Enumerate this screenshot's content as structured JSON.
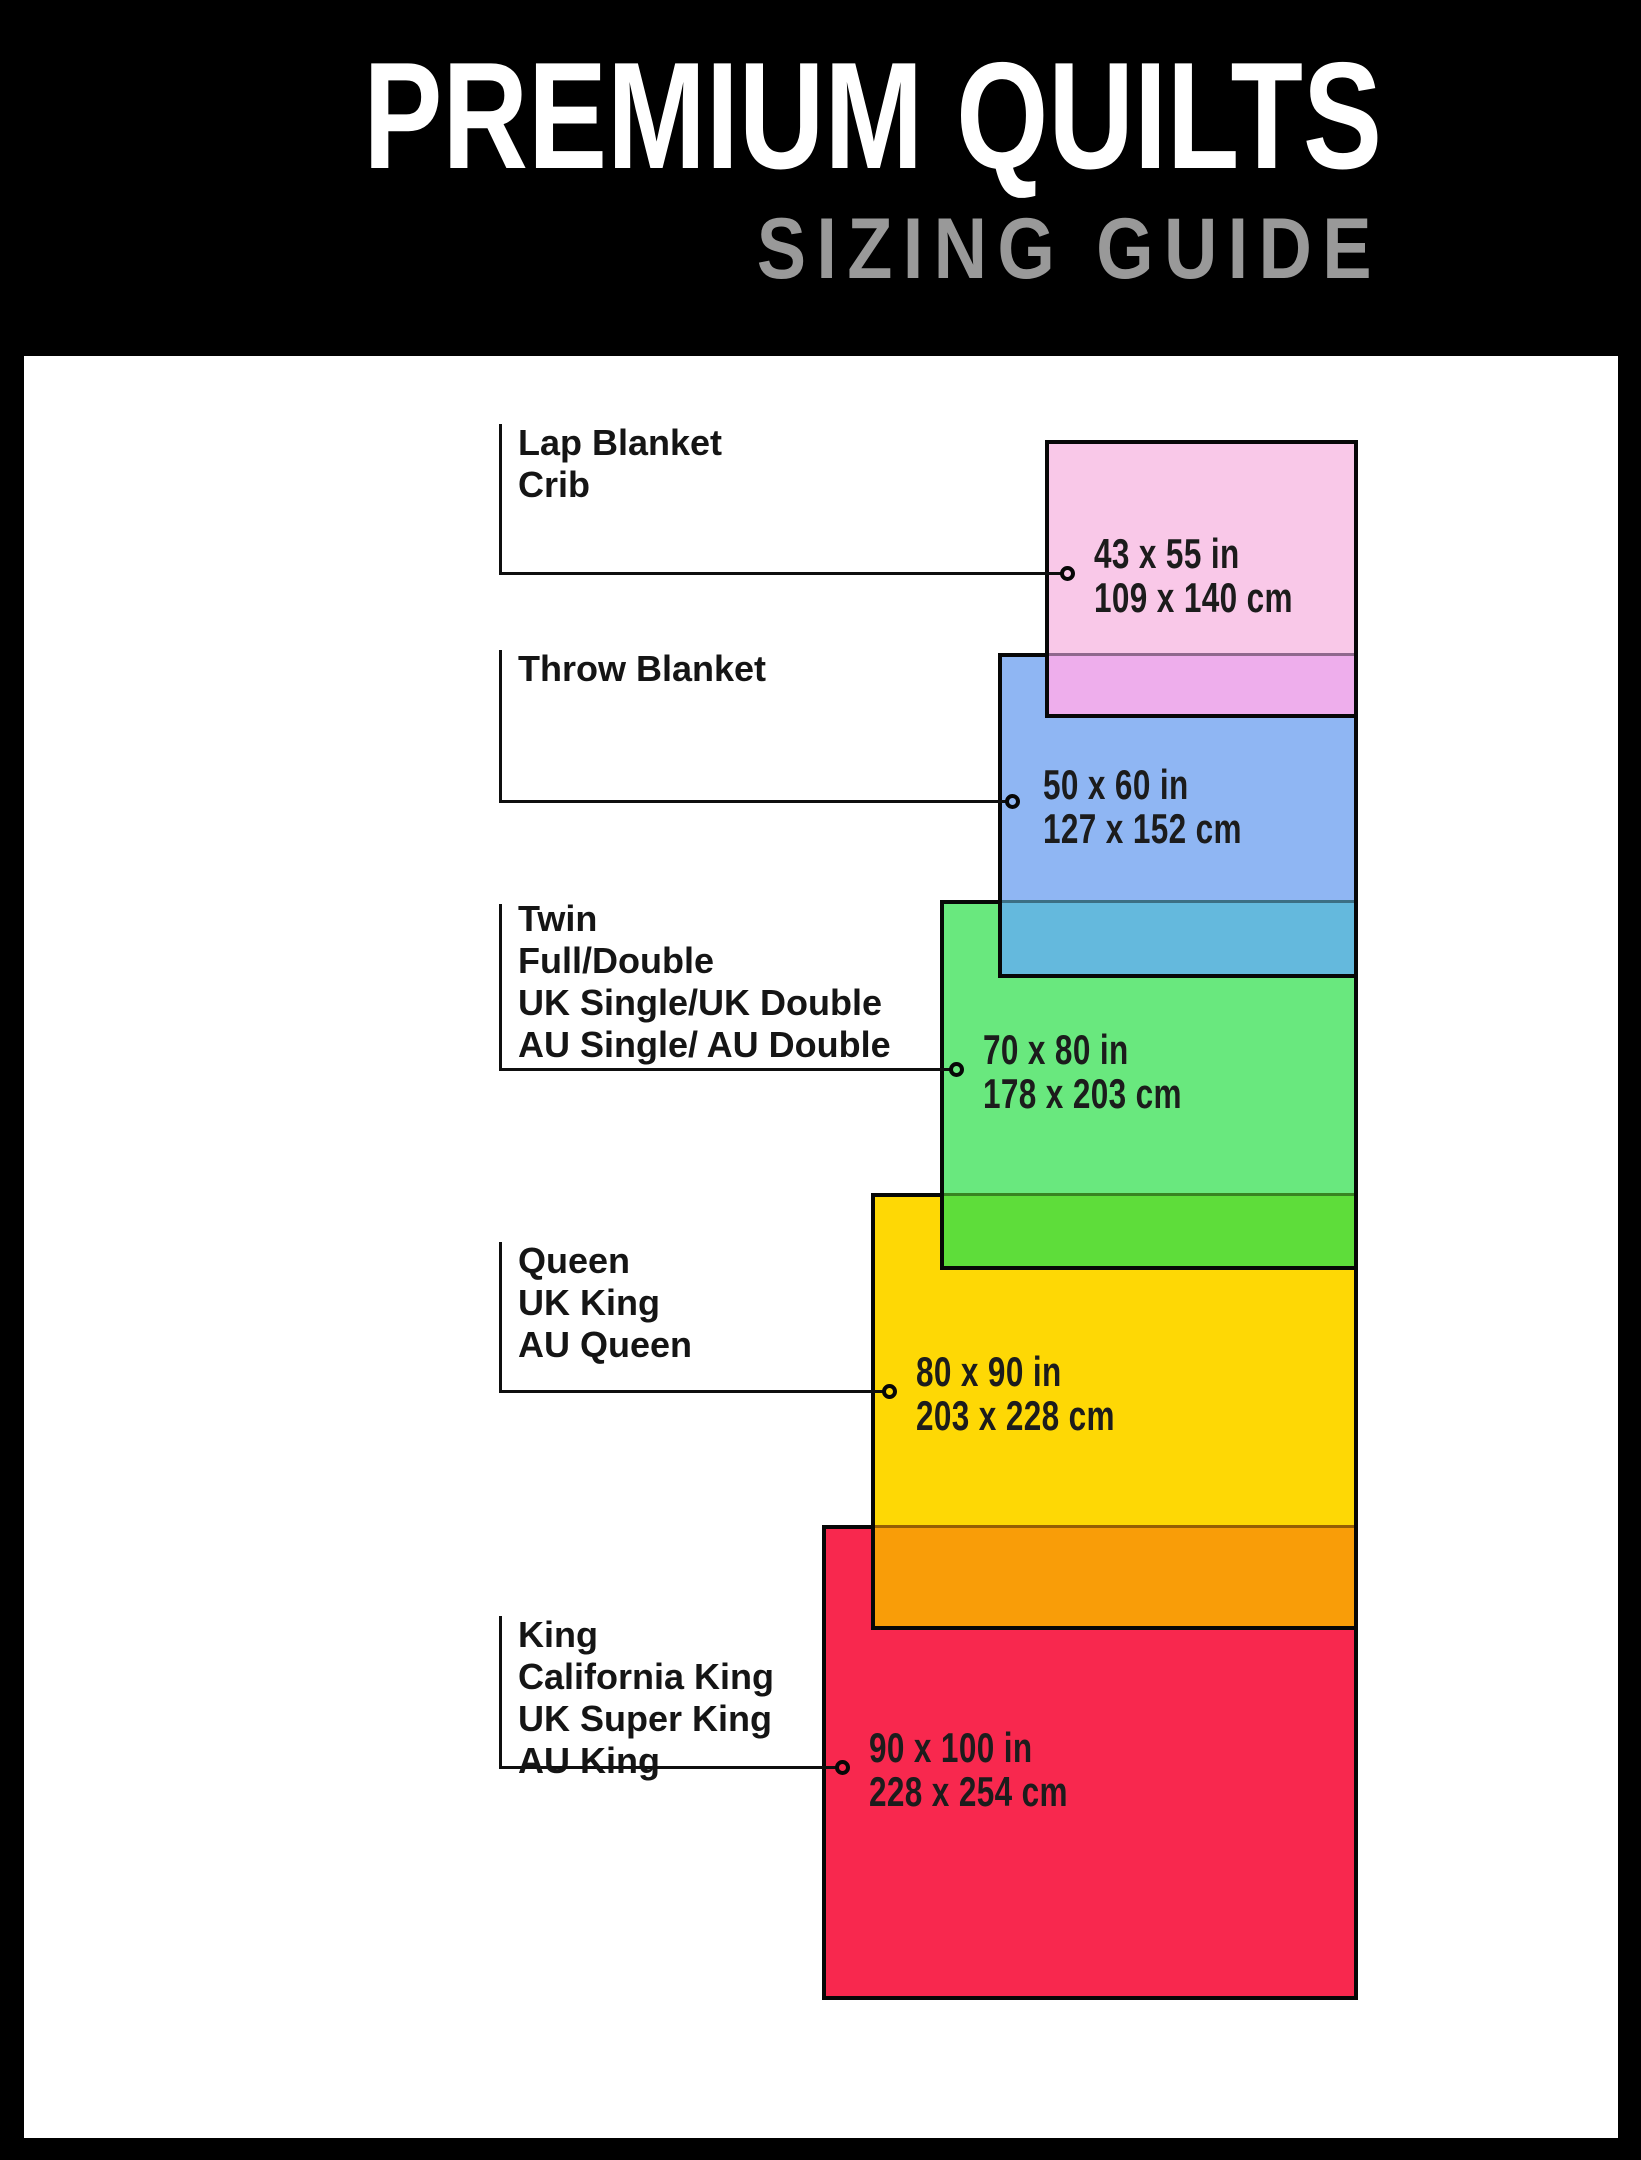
{
  "header": {
    "title": "PREMIUM QUILTS",
    "subtitle": "SIZING GUIDE"
  },
  "palette": {
    "background": "#000000",
    "panel": "#ffffff",
    "line": "#0f0f0f",
    "title_color": "#ffffff",
    "subtitle_color": "#999999"
  },
  "sizes": [
    {
      "names": [
        "Lap Blanket",
        "Crib"
      ],
      "inches": "43 x 55 in",
      "cm": "109 x 140 cm",
      "fill": "#f9c8e8",
      "overlap_fill": "#eeaeec"
    },
    {
      "names": [
        "Throw Blanket"
      ],
      "inches": "50 x 60 in",
      "cm": "127 x 152 cm",
      "fill": "#8fb6f3",
      "overlap_fill": "#64b9dd"
    },
    {
      "names": [
        "Twin",
        "Full/Double",
        "UK Single/UK Double",
        "AU Single/ AU Double"
      ],
      "inches": "70 x 80 in",
      "cm": "178 x 203 cm",
      "fill": "#69e87e",
      "overlap_fill": "#5edd3a"
    },
    {
      "names": [
        "Queen",
        "UK King",
        "AU Queen"
      ],
      "inches": "80 x 90 in",
      "cm": "203 x 228 cm",
      "fill": "#fed805",
      "overlap_fill": "#f99d08"
    },
    {
      "names": [
        "King",
        "California King",
        "UK Super King",
        "AU King"
      ],
      "inches": "90 x 100 in",
      "cm": "228 x 254 cm",
      "fill": "#f8284e",
      "overlap_fill": null
    }
  ]
}
